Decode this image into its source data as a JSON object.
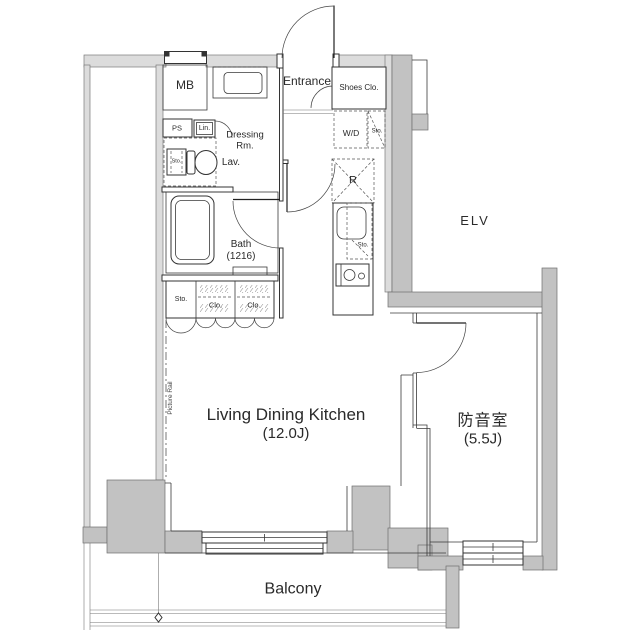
{
  "plan": {
    "rooms": {
      "entrance": {
        "label": "Entrance"
      },
      "dressing_room": {
        "line1": "Dressing",
        "line2": "Rm."
      },
      "bath": {
        "label": "Bath",
        "size": "(1216)"
      },
      "living_dining_kitchen": {
        "label": "Living Dining Kitchen",
        "size": "(12.0J)"
      },
      "soundproof_room": {
        "label": "防音室",
        "size": "(5.5J)"
      },
      "balcony": {
        "label": "Balcony"
      },
      "elevator": {
        "label": "ELV"
      }
    },
    "fixtures": {
      "meter_box": "MB",
      "pipe_space": "PS",
      "linen": "Lin.",
      "lavatory": "Lav.",
      "shoes_closet": "Shoes Clo.",
      "washer_dryer": "W/D",
      "refrigerator": "R",
      "storage": "Sto.",
      "closet": "Clo.",
      "picture_rail": "Picture Rail"
    },
    "colors": {
      "wall_light": "#dcdcdc",
      "wall_medium": "#c2c2c2",
      "line": "#3a3a3a"
    }
  }
}
